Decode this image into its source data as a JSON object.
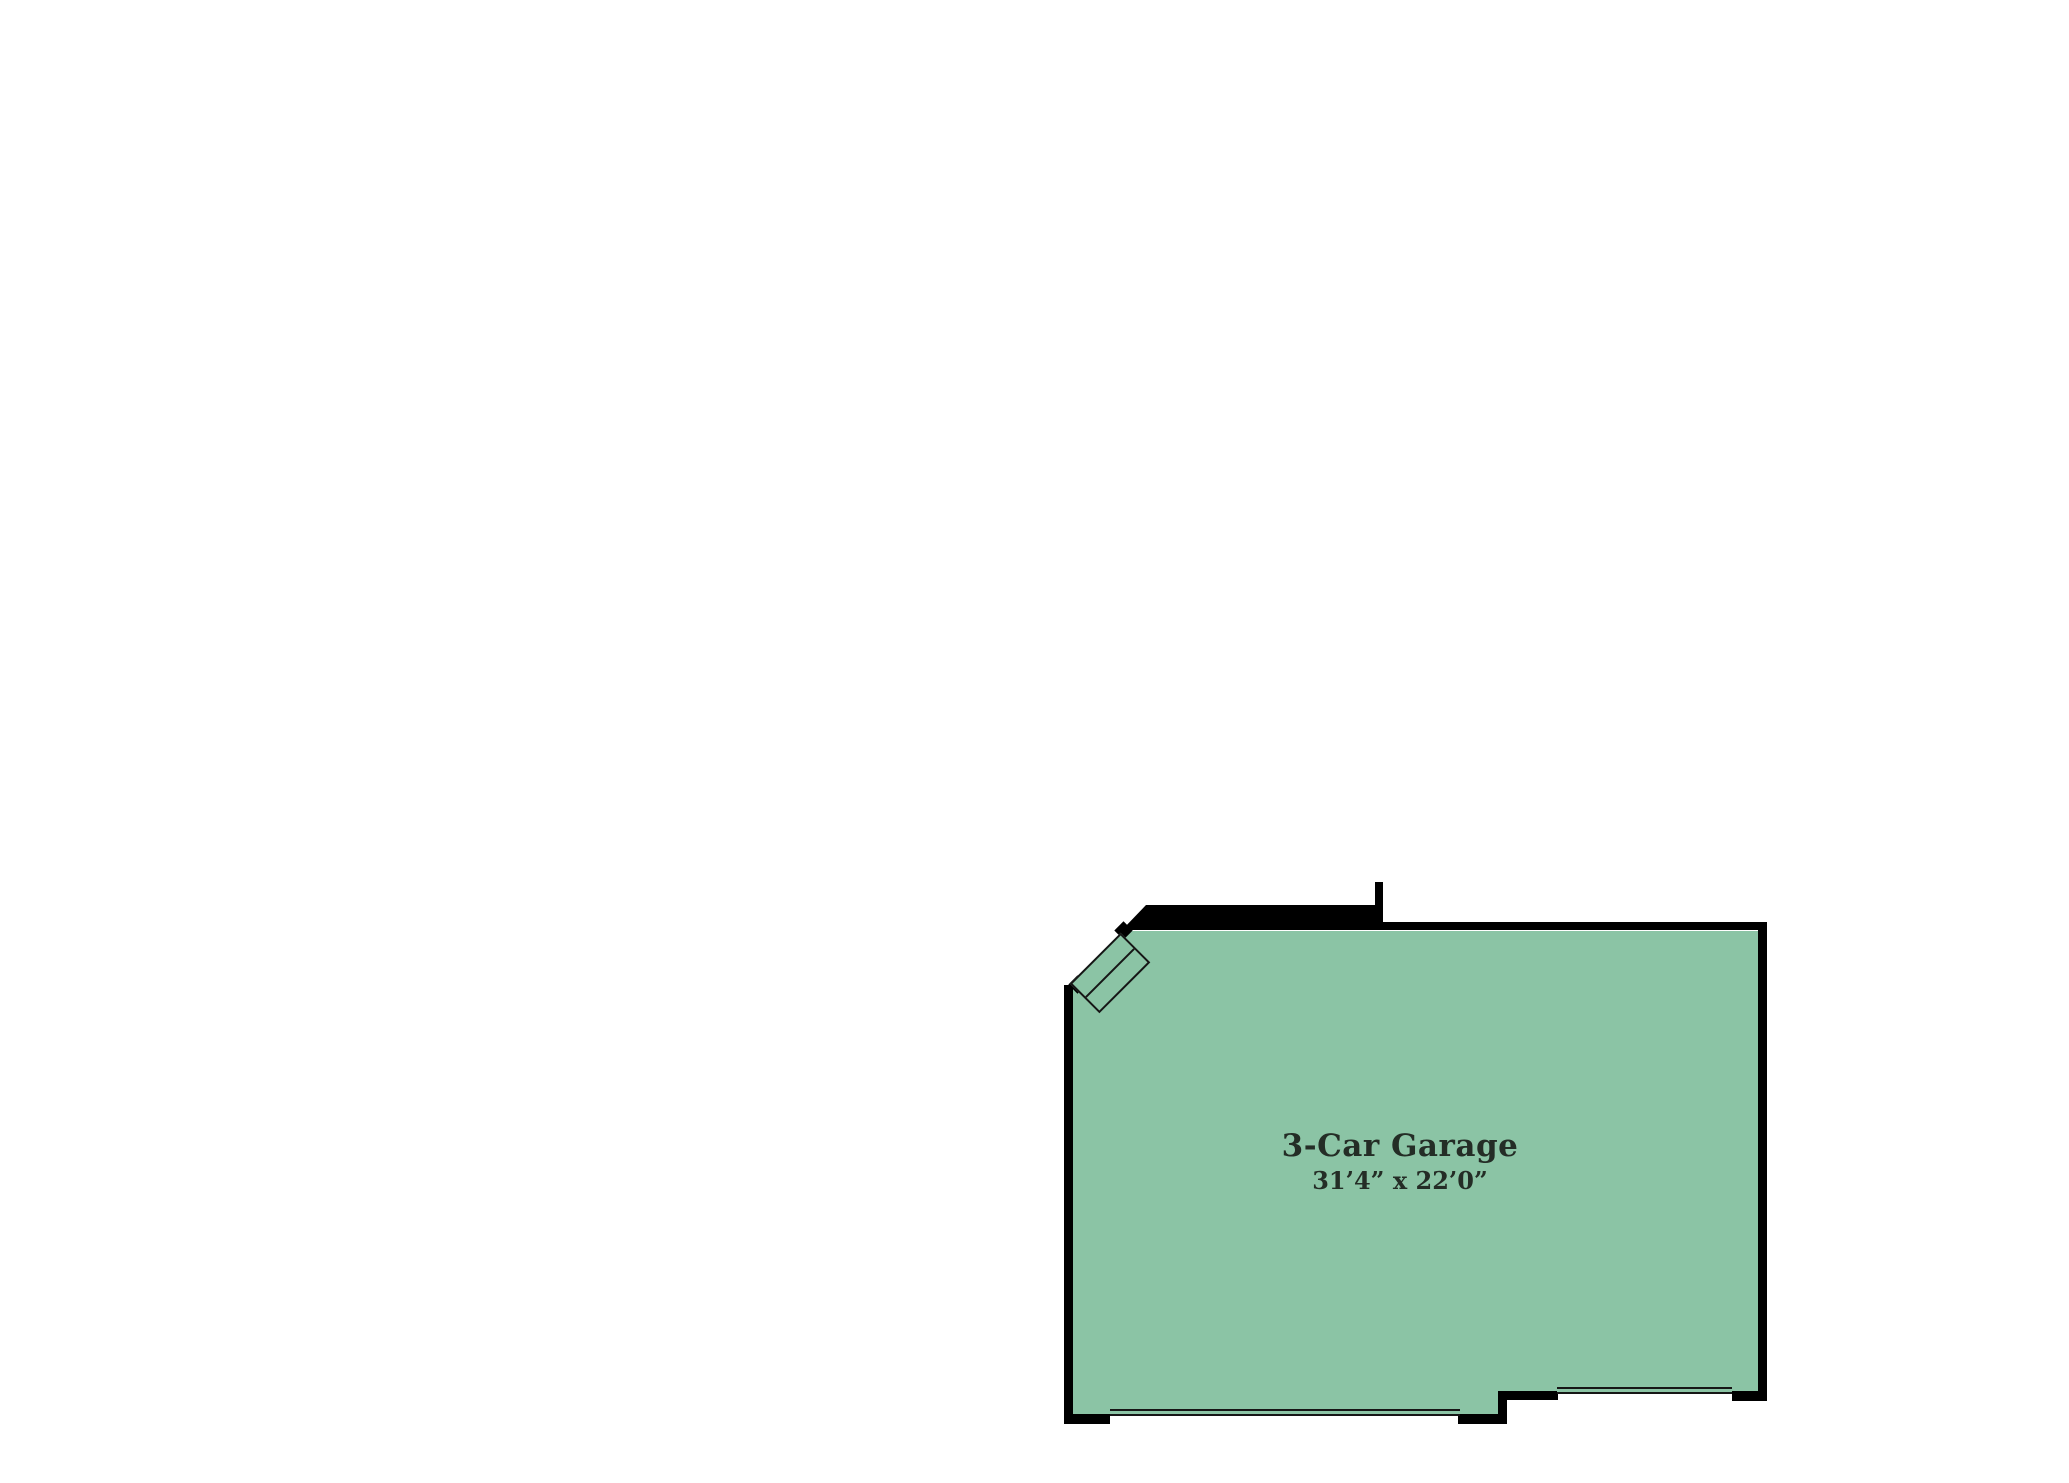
{
  "colors": {
    "page_bg": "#ffffff",
    "room_fill": "#8BC4A5",
    "wall": "#000000",
    "line": "#161616",
    "text": "#242d26"
  },
  "room": {
    "name": "3-Car Garage",
    "dimensions": "31’4” x 22’0”"
  }
}
